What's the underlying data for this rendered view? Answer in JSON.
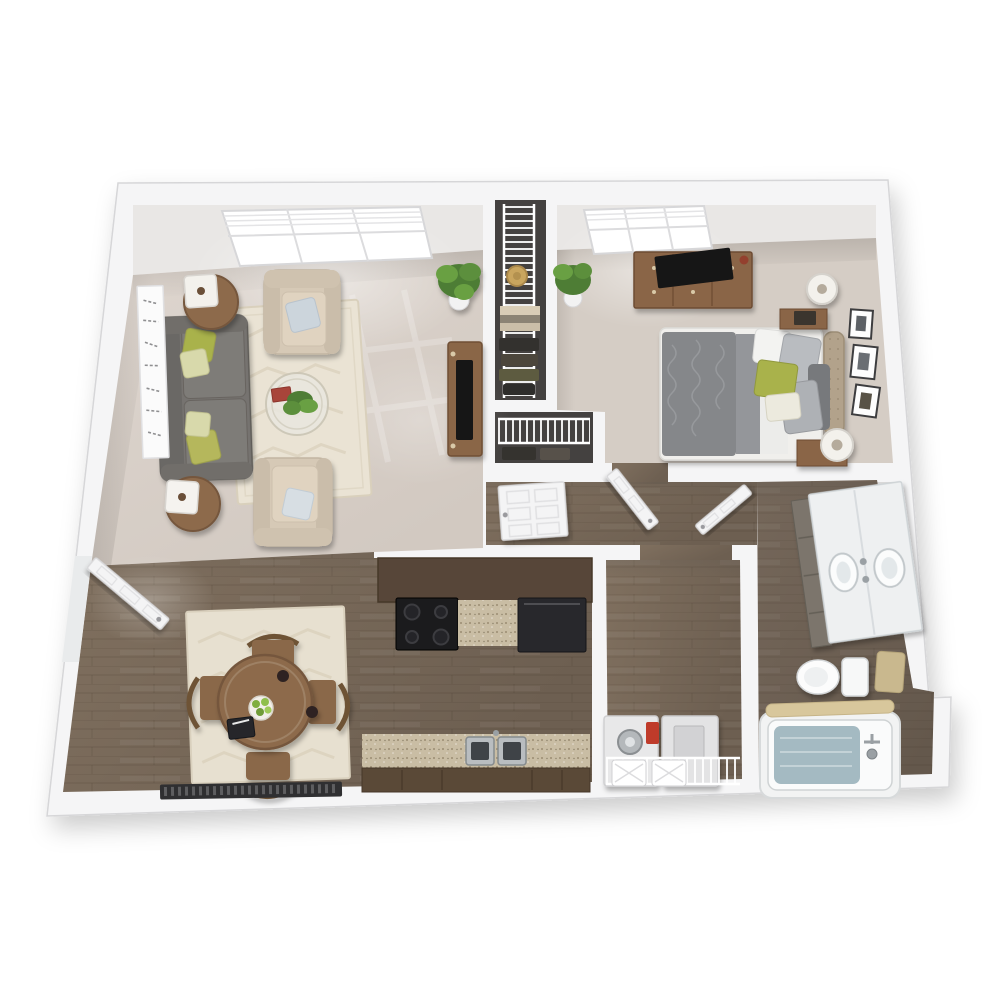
{
  "title": "3D top-down floor plan of a one-bedroom, one-bathroom apartment",
  "colors": {
    "background": "#ffffff",
    "wall": "#f5f5f6",
    "wall_face": "#e9e7e5",
    "wall_edge": "#d6d6d8",
    "carpet": "#d8d0c8",
    "carpet_bedroom": "#d5cdc5",
    "wood": "#77685a",
    "wood_bath": "#6b5d50",
    "closet_floor": "#444140",
    "rug_living": "#eae3d4",
    "rug_dining": "#e7e0d0",
    "sofa_gray": "#767370",
    "armchair_beige": "#d6c9b6",
    "furniture_wood": "#8a6647",
    "table_wood": "#8d6b4b",
    "granite": "#c9bda4",
    "stove_black": "#1b1b1d",
    "appliance_dark": "#28282c",
    "appliance_white": "#e8e8e9",
    "duvet_gray": "#85878a",
    "sheet_white": "#ececea",
    "headboard_tan": "#b2a28b",
    "pillow_green": "#a9b24b",
    "pillow_blue": "#ccd5dc",
    "tub_mat_blue": "#a4bac2",
    "towel_tan": "#c9b88e",
    "vanity_counter": "#eef0f1",
    "vanity_cabinet": "#7b756c",
    "door_white": "#f4f4f5",
    "plant_green": "#4e7d35",
    "plant_light": "#69a043",
    "accent_red": "#bf3a2c",
    "lamp_white": "#f3f1ec",
    "tv_black": "#151517",
    "heater_dark": "#2f2f31",
    "art_canvas": "#fbfbfb",
    "apples_green": "#7fae3f"
  },
  "rooms": [
    {
      "id": "living-room",
      "label": "Living Room",
      "items": [
        "gray sofa with accent pillows",
        "two round end tables with square lamps",
        "two beige armchairs with throw pillows",
        "round glass coffee table with plant and book",
        "cream patterned area rug",
        "potted corner plant",
        "script wall art",
        "TV stand with television",
        "picture window with blinds"
      ]
    },
    {
      "id": "dining-area",
      "label": "Dining Area",
      "items": [
        "round wood dining table",
        "four wood chairs",
        "bowl of green apples",
        "open notebook",
        "cream rug",
        "baseboard heater",
        "front entry door"
      ]
    },
    {
      "id": "kitchen",
      "label": "Galley Kitchen",
      "items": [
        "black range with four burners",
        "granite countertops",
        "dark refrigerator",
        "stainless double sink",
        "dark wood cabinets"
      ]
    },
    {
      "id": "bedroom",
      "label": "Bedroom",
      "items": [
        "bed with gray damask duvet",
        "green accent pillow",
        "tufted tan headboard",
        "two nightstands with drum lamps",
        "dresser with television",
        "three framed pictures",
        "potted plant",
        "window with blinds"
      ]
    },
    {
      "id": "bathroom",
      "label": "Bathroom",
      "items": [
        "double-sink vanity",
        "toilet",
        "bathtub with blue mat",
        "hand towel",
        "towel draped on tub"
      ]
    },
    {
      "id": "laundry-closet",
      "label": "Laundry Closet",
      "items": [
        "washer",
        "dryer",
        "wire shelf with two baskets",
        "red detergent bottle"
      ]
    },
    {
      "id": "walk-in-closet",
      "label": "Walk-in Closet",
      "items": [
        "wire shelving",
        "hanging clothes",
        "sun hat",
        "folded blankets"
      ]
    },
    {
      "id": "hall-closet",
      "label": "Hall Closet",
      "items": [
        "wire shelf",
        "hanging clothes",
        "white six-panel door"
      ]
    },
    {
      "id": "hallway",
      "label": "Hallway",
      "items": [
        "open bedroom door",
        "open bathroom door",
        "closed closet door"
      ]
    }
  ]
}
